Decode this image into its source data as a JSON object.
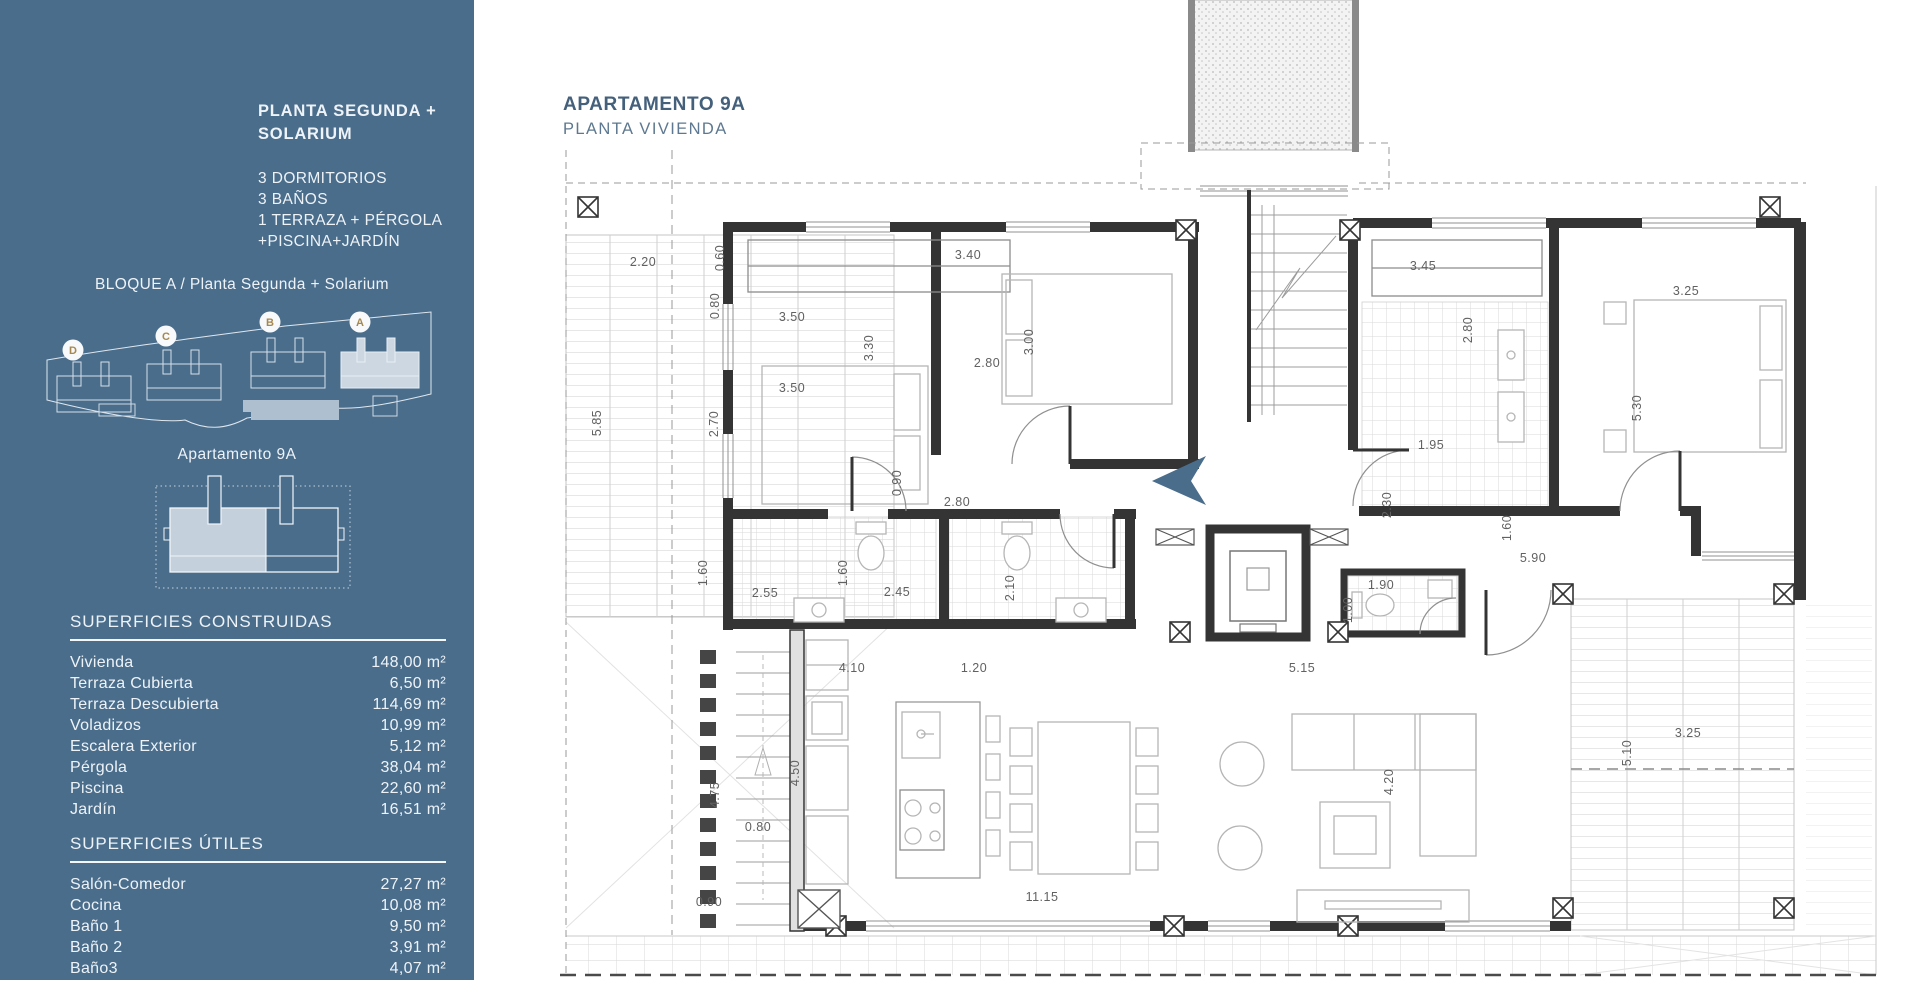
{
  "colors": {
    "sidebar_bg": "#4A6D8C",
    "accent_text": "#44607B",
    "subtitle_text": "#5D7890",
    "badge_letter": "#A5874F",
    "dim_text": "#616161",
    "entrance_arrow": "#4A6D8C"
  },
  "sidebar": {
    "title": "PLANTA SEGUNDA +\nSOLARIUM",
    "features": [
      "3 DORMITORIOS",
      "3 BAÑOS",
      "1 TERRAZA + PÉRGOLA",
      "+PISCINA+JARDÍN"
    ],
    "block_label": "BLOQUE A / Planta Segunda + Solarium",
    "siteplan": {
      "badges": [
        {
          "label": "D",
          "x": 38,
          "y": 48
        },
        {
          "label": "C",
          "x": 131,
          "y": 34
        },
        {
          "label": "B",
          "x": 235,
          "y": 20
        },
        {
          "label": "A",
          "x": 325,
          "y": 20
        }
      ]
    },
    "apartment_label": "Apartamento 9A",
    "sections": [
      {
        "heading": "SUPERFICIES CONSTRUIDAS",
        "rows": [
          {
            "label": "Vivienda",
            "value": "148,00 m²"
          },
          {
            "label": "Terraza Cubierta",
            "value": "6,50 m²"
          },
          {
            "label": "Terraza Descubierta",
            "value": "114,69 m²"
          },
          {
            "label": "Voladizos",
            "value": "10,99 m²"
          },
          {
            "label": "Escalera Exterior",
            "value": "5,12 m²"
          },
          {
            "label": "Pérgola",
            "value": "38,04 m²"
          },
          {
            "label": "Piscina",
            "value": "22,60 m²"
          },
          {
            "label": "Jardín",
            "value": "16,51 m²"
          }
        ]
      },
      {
        "heading": "SUPERFICIES ÚTILES",
        "rows": [
          {
            "label": "Salón-Comedor",
            "value": "27,27 m²"
          },
          {
            "label": "Cocina",
            "value": "10,08 m²"
          },
          {
            "label": "Baño 1",
            "value": "9,50 m²"
          },
          {
            "label": "Baño 2",
            "value": "3,91 m²"
          },
          {
            "label": "Baño3",
            "value": "4,07 m²"
          }
        ]
      }
    ]
  },
  "plan": {
    "title": "APARTAMENTO 9A",
    "subtitle": "PLANTA VIVIENDA",
    "dimensions": [
      {
        "t": "2.20",
        "x": 643,
        "y": 266
      },
      {
        "t": "5.85",
        "x": 601,
        "y": 423,
        "v": 1
      },
      {
        "t": "0.60",
        "x": 724,
        "y": 258,
        "v": 1
      },
      {
        "t": "0.80",
        "x": 719,
        "y": 306,
        "v": 1
      },
      {
        "t": "3.50",
        "x": 792,
        "y": 321
      },
      {
        "t": "3.40",
        "x": 968,
        "y": 259
      },
      {
        "t": "3.30",
        "x": 873,
        "y": 348,
        "v": 1
      },
      {
        "t": "2.80",
        "x": 987,
        "y": 367
      },
      {
        "t": "3.00",
        "x": 1033,
        "y": 342,
        "v": 1
      },
      {
        "t": "3.50",
        "x": 792,
        "y": 392
      },
      {
        "t": "2.70",
        "x": 718,
        "y": 424,
        "v": 1
      },
      {
        "t": "0.90",
        "x": 901,
        "y": 483,
        "v": 1
      },
      {
        "t": "2.80",
        "x": 957,
        "y": 506
      },
      {
        "t": "1.60",
        "x": 707,
        "y": 573,
        "v": 1
      },
      {
        "t": "2.55",
        "x": 765,
        "y": 597
      },
      {
        "t": "1.60",
        "x": 847,
        "y": 573,
        "v": 1
      },
      {
        "t": "2.45",
        "x": 897,
        "y": 596
      },
      {
        "t": "2.10",
        "x": 1014,
        "y": 588,
        "v": 1
      },
      {
        "t": "3.45",
        "x": 1423,
        "y": 270
      },
      {
        "t": "2.80",
        "x": 1472,
        "y": 330,
        "v": 1
      },
      {
        "t": "3.25",
        "x": 1686,
        "y": 295
      },
      {
        "t": "5.30",
        "x": 1641,
        "y": 408,
        "v": 1
      },
      {
        "t": "1.95",
        "x": 1431,
        "y": 449
      },
      {
        "t": "2.30",
        "x": 1391,
        "y": 505,
        "v": 1
      },
      {
        "t": "1.60",
        "x": 1511,
        "y": 528,
        "v": 1
      },
      {
        "t": "5.90",
        "x": 1533,
        "y": 562
      },
      {
        "t": "1.90",
        "x": 1381,
        "y": 589
      },
      {
        "t": "1.00",
        "x": 1352,
        "y": 610,
        "v": 1
      },
      {
        "t": "4.10",
        "x": 852,
        "y": 672
      },
      {
        "t": "1.20",
        "x": 974,
        "y": 672
      },
      {
        "t": "5.15",
        "x": 1302,
        "y": 672
      },
      {
        "t": "4.50",
        "x": 799,
        "y": 773,
        "v": 1
      },
      {
        "t": "4.75",
        "x": 719,
        "y": 795,
        "v": 1
      },
      {
        "t": "0.80",
        "x": 758,
        "y": 831
      },
      {
        "t": "0.90",
        "x": 709,
        "y": 906
      },
      {
        "t": "11.15",
        "x": 1042,
        "y": 901
      },
      {
        "t": "4.20",
        "x": 1393,
        "y": 782,
        "v": 1
      },
      {
        "t": "3.25",
        "x": 1688,
        "y": 737
      },
      {
        "t": "5.10",
        "x": 1631,
        "y": 753,
        "v": 1
      }
    ]
  }
}
